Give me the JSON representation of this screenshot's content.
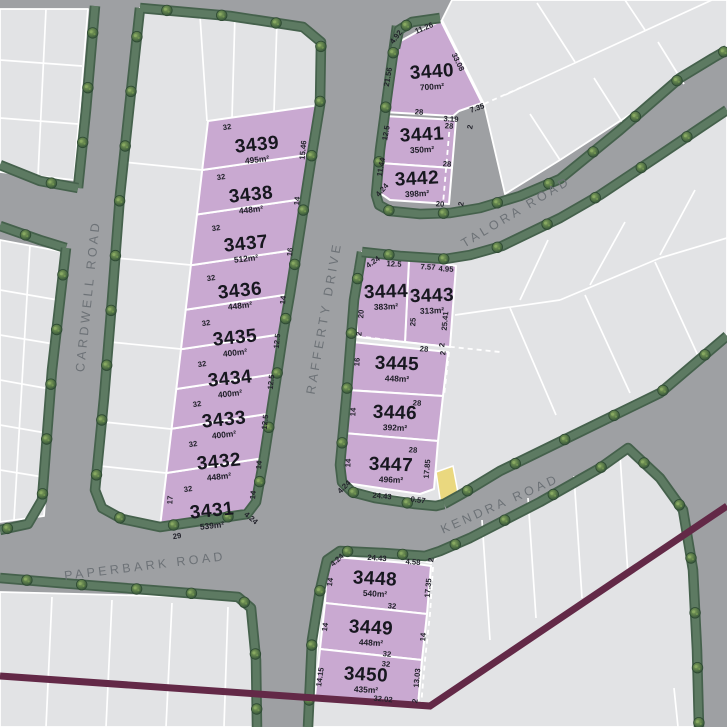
{
  "map": {
    "roads": [
      {
        "name": "CARDWELL ROAD"
      },
      {
        "name": "RAFFERTY DRIVE"
      },
      {
        "name": "TALORA ROAD"
      },
      {
        "name": "KENDRA ROAD"
      },
      {
        "name": "PAPERBARK ROAD"
      }
    ],
    "lots": [
      {
        "number": "3431",
        "area": "539m²",
        "dims": [
          "32",
          "17",
          "29",
          "14",
          "4.24"
        ]
      },
      {
        "number": "3432",
        "area": "448m²",
        "dims": [
          "32",
          "14"
        ]
      },
      {
        "number": "3433",
        "area": "400m²",
        "dims": [
          "32",
          "12.5"
        ]
      },
      {
        "number": "3434",
        "area": "400m²",
        "dims": [
          "32",
          "12.5"
        ]
      },
      {
        "number": "3435",
        "area": "400m²",
        "dims": [
          "32",
          "12.5"
        ]
      },
      {
        "number": "3436",
        "area": "448m²",
        "dims": [
          "32",
          "14"
        ]
      },
      {
        "number": "3437",
        "area": "512m²",
        "dims": [
          "32",
          "16"
        ]
      },
      {
        "number": "3438",
        "area": "448m²",
        "dims": [
          "32",
          "14"
        ]
      },
      {
        "number": "3439",
        "area": "495m²",
        "dims": [
          "32",
          "15.46"
        ]
      },
      {
        "number": "3440",
        "area": "700m²",
        "dims": [
          "4.92",
          "11.26",
          "21.56",
          "33.08",
          "28",
          "3.19",
          "7.35"
        ]
      },
      {
        "number": "3441",
        "area": "350m²",
        "dims": [
          "28",
          "12.5",
          "28",
          "2"
        ]
      },
      {
        "number": "3442",
        "area": "398m²",
        "dims": [
          "11.44",
          "4.24",
          "20",
          "2"
        ]
      },
      {
        "number": "3443",
        "area": "313m²",
        "dims": [
          "7.57",
          "4.95",
          "25.41",
          "2"
        ]
      },
      {
        "number": "3444",
        "area": "383m²",
        "dims": [
          "4.24",
          "12.5",
          "20",
          "2",
          "25"
        ]
      },
      {
        "number": "3445",
        "area": "448m²",
        "dims": [
          "28",
          "16",
          "2"
        ]
      },
      {
        "number": "3446",
        "area": "392m²",
        "dims": [
          "28",
          "14"
        ]
      },
      {
        "number": "3447",
        "area": "496m²",
        "dims": [
          "28",
          "14",
          "4.24",
          "24.43",
          "0.57",
          "17.85"
        ]
      },
      {
        "number": "3448",
        "area": "540m²",
        "dims": [
          "4.24",
          "24.43",
          "4.58",
          "2",
          "14",
          "17.35",
          "32"
        ]
      },
      {
        "number": "3449",
        "area": "448m²",
        "dims": [
          "14",
          "14",
          "32"
        ]
      },
      {
        "number": "3450",
        "area": "435m²",
        "dims": [
          "32",
          "14.15",
          "13.03",
          "32.02",
          "2"
        ]
      }
    ],
    "colors": {
      "road_gray": "#9ea0a3",
      "lot_gray": "#e2e3e5",
      "lot_purple": "#c9a9d1",
      "lot_yellow": "#ead87f",
      "verge_green": "#5d7a62",
      "verge_edge_green": "#45614c",
      "tree_green": "#567747",
      "boundary_maroon": "#632947",
      "line_white": "#ffffff",
      "lot_text": "#17171f",
      "road_text": "#6d7277"
    }
  }
}
